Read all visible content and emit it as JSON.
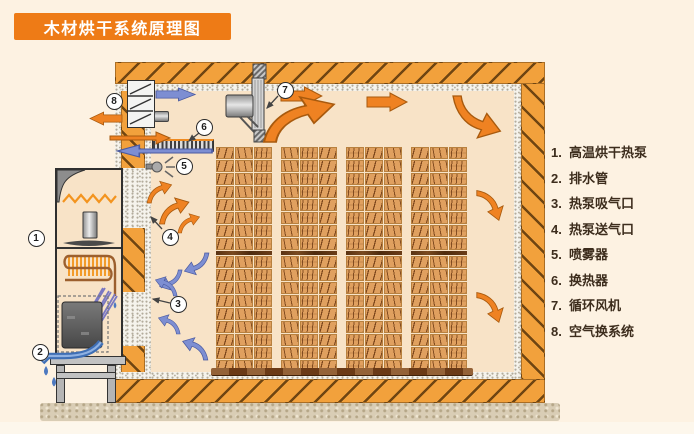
{
  "title": "木材烘干系统原理图",
  "legend": {
    "items": [
      {
        "num": "1.",
        "label": "高温烘干热泵"
      },
      {
        "num": "2.",
        "label": "排水管"
      },
      {
        "num": "3.",
        "label": "热泵吸气口"
      },
      {
        "num": "4.",
        "label": "热泵送气口"
      },
      {
        "num": "5.",
        "label": "喷雾器"
      },
      {
        "num": "6.",
        "label": "换热器"
      },
      {
        "num": "7.",
        "label": "循环风机"
      },
      {
        "num": "8.",
        "label": "空气换系统"
      }
    ]
  },
  "callouts": [
    "1",
    "2",
    "3",
    "4",
    "5",
    "6",
    "7",
    "8"
  ],
  "colors": {
    "accent_orange": "#ee7b16",
    "wall_orange": "#f2a13c",
    "arrow_orange": "#ef8222",
    "arrow_blue": "#7d8ed2",
    "wood": "#e0a05f",
    "interior": "#f8e3c7",
    "background": "#fdf2e2"
  },
  "wood_stacks": {
    "groups": 4,
    "columns_per_group": 3,
    "rows": 17,
    "separator_after_row": 8
  }
}
